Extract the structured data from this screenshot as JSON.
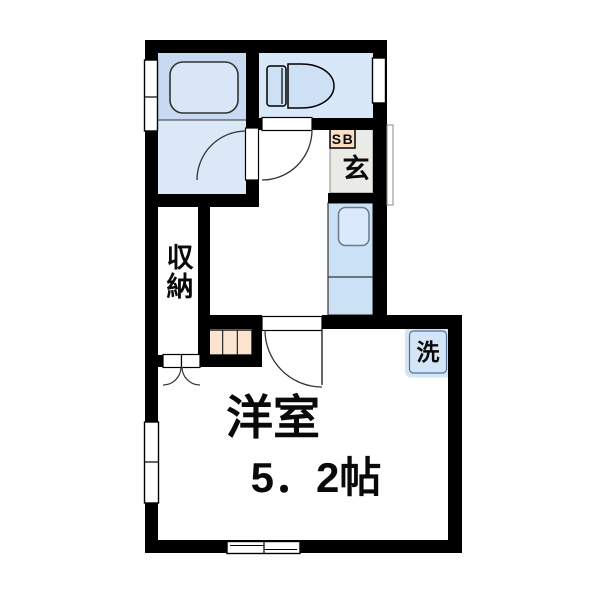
{
  "plan": {
    "type": "floor-plan",
    "rooms": {
      "entrance": {
        "label": "玄",
        "shoebox_label": "SB"
      },
      "closet": {
        "label": "収納",
        "label_vertical_chars": [
          "収",
          "納"
        ]
      },
      "washer": {
        "label": "洗"
      },
      "main_room": {
        "name": "洋室",
        "size": "5．2帖"
      }
    }
  },
  "colors": {
    "wall": "#000000",
    "bath_upper_bg": "#c7daf1",
    "bath_lower_bg": "#dae8f8",
    "tub_fill": "#d8e6f7",
    "toilet_room_bg": "#d9e8f8",
    "fixture_fill": "#cde0f4",
    "genkan_bg": "#eaeae7",
    "shoebox_fill": "#f9dfc6",
    "step_fill": "#fae4cf",
    "counter_fill": "#cbe1f6",
    "sink_fill": "#daeafc",
    "washer_fill": "#d4e5f7",
    "washer_border": "#4f6f94",
    "door_line": "#333333",
    "text": "#0a0a0a"
  }
}
